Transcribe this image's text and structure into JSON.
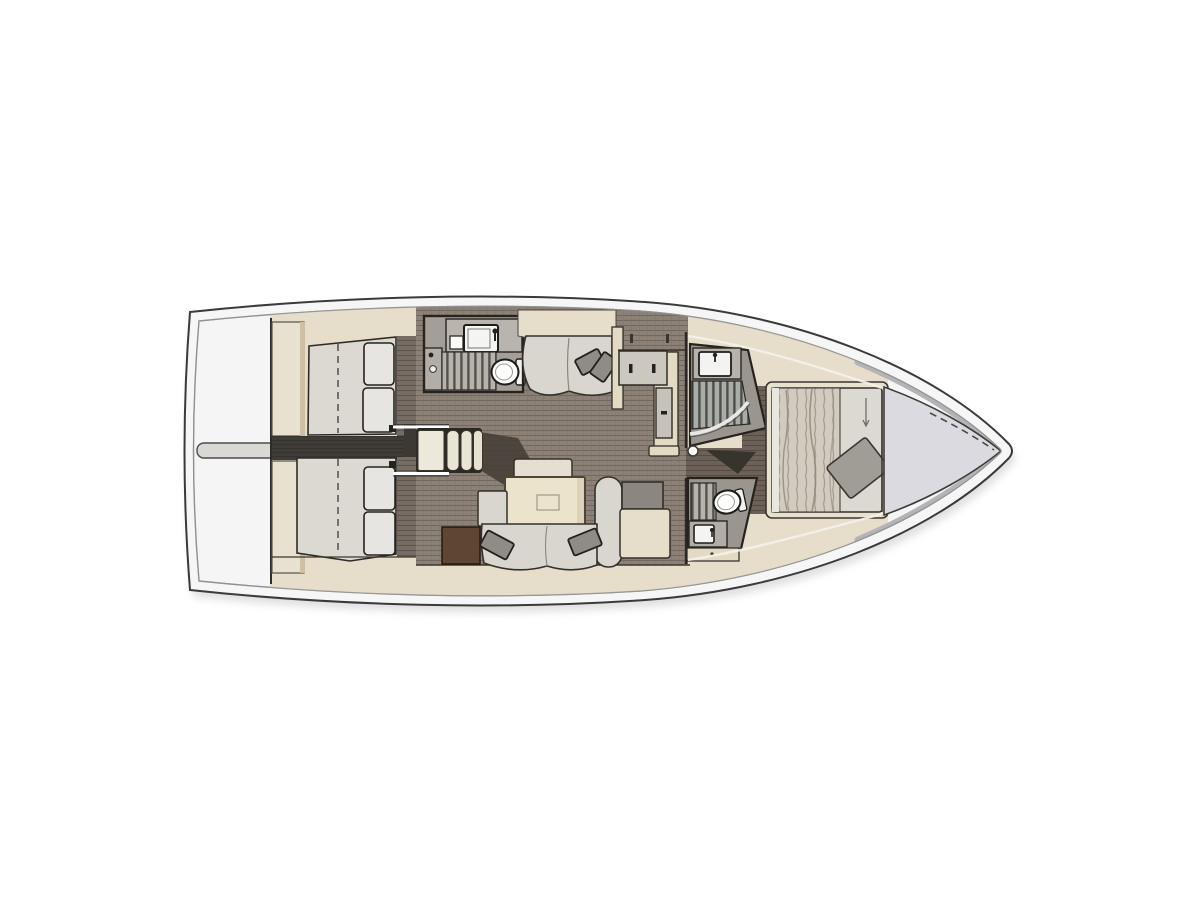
{
  "diagram": {
    "type": "yacht-interior-floor-plan",
    "orientation": "bow-right",
    "rooms": [
      "stern-deck",
      "port-aft-cabin",
      "starboard-aft-cabin",
      "companionway-steps",
      "salon",
      "aft-head-with-shower",
      "galley-counter",
      "forward-shower-room",
      "forward-head",
      "owners-cabin",
      "bow-locker"
    ]
  },
  "colors": {
    "page_bg": "#ffffff",
    "hull_fill": "#f6f6f7",
    "hull_outline": "#3a3a3a",
    "deck_line": "#9a9a9a",
    "bow_band": "#b4b4b8",
    "cabinetry_beige": "#e6decb",
    "cabinetry_beige_dark": "#e3dac3",
    "trim_beige_shadow": "#cdbfa4",
    "salon_floor": "#8b8177",
    "salon_floor_line": "#6f665d",
    "cabin_floor": "#756c63",
    "fwd_floor": "#6b6158",
    "passage_floor": "#3f3b36",
    "mattress": "#dcd8d2",
    "cushion": "#e7e5e2",
    "duvet": "#d2cbc0",
    "pillow_gray": "#8f8b85",
    "fwd_pillow": "#a09d97",
    "sofa": "#d9d5cf",
    "table": "#ece3cd",
    "bench": "#e5dfd1",
    "counter_gray": "#b9b5ae",
    "cabinet_face": "#ccc8c0",
    "dark_cabinet": "#8b8780",
    "fixture_white": "#f4f4f2",
    "toilet_white": "#fdfdfc",
    "slat_light": "#b6b3ac",
    "slat_dark": "#56534d",
    "steps_cream": "#eee8da",
    "steps_base": "#2c2824",
    "brown_chest": "#5f4533",
    "wall_dark": "#26231f",
    "shadow_blotch": "#453f38",
    "bow_locker": "#dadae0",
    "stern_bar": "#dad8d4"
  }
}
